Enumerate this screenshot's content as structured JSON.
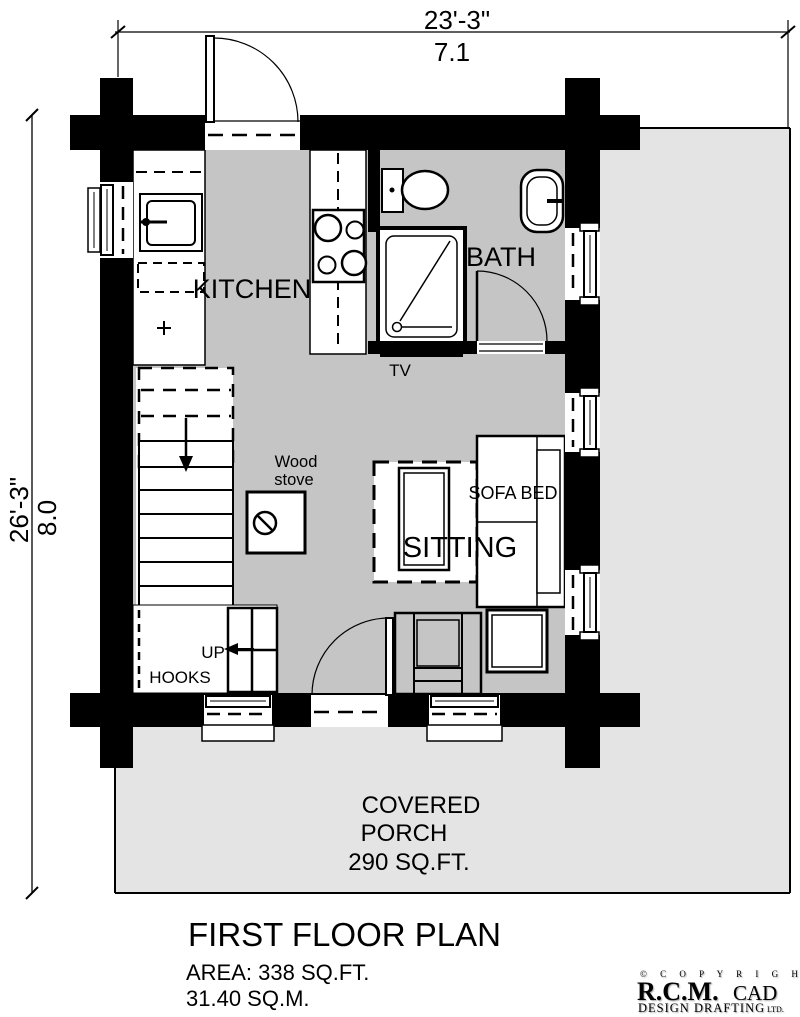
{
  "drawing": {
    "type": "architectural-floor-plan"
  },
  "dimensions": {
    "top_imperial": "23'-3\"",
    "top_metric": "7.1",
    "left_imperial": "26'-3\"",
    "left_metric": "8.0"
  },
  "rooms": {
    "kitchen": "KITCHEN",
    "bath": "BATH",
    "sitting": "SITTING"
  },
  "fixtures": {
    "tv": "TV",
    "wood_stove_line1": "Wood",
    "wood_stove_line2": "stove",
    "sofa_bed": "SOFA BED",
    "up": "UP",
    "hooks": "HOOKS"
  },
  "porch": {
    "line1": "COVERED",
    "line2": "PORCH",
    "line3": "290 SQ.FT."
  },
  "footer": {
    "title": "FIRST FLOOR PLAN",
    "area_imperial": "AREA: 338 SQ.FT.",
    "area_metric": "31.40 SQ.M."
  },
  "copyright": {
    "line1": "© C O P Y R I G H T",
    "company": "R.C.M.",
    "cad": "CAD",
    "line2": "DESIGN DRAFTING",
    "ltd": "LTD."
  },
  "colors": {
    "wall": "#000000",
    "interior_floor": "#c5c5c5",
    "porch": "#e4e4e4",
    "fixture": "#ffffff"
  }
}
